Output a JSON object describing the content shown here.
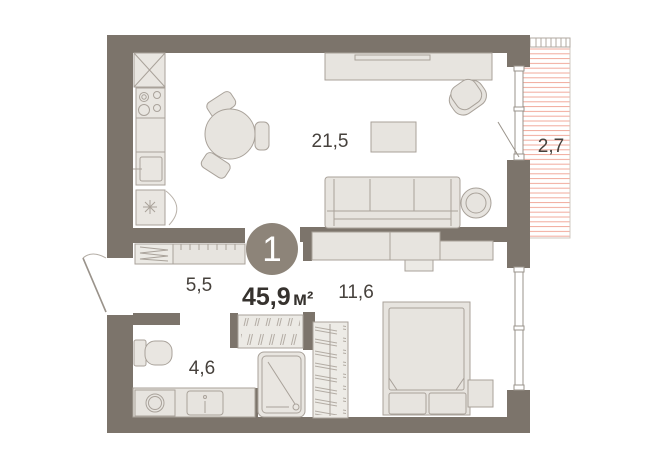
{
  "plan": {
    "unit_number": "1",
    "total_area_value": "45,9",
    "total_area_unit": "м²",
    "rooms": [
      {
        "id": "living-kitchen",
        "area_label": "21,5"
      },
      {
        "id": "balcony",
        "area_label": "2,7"
      },
      {
        "id": "hallway",
        "area_label": "5,5"
      },
      {
        "id": "bathroom",
        "area_label": "4,6"
      },
      {
        "id": "bedroom",
        "area_label": "11,6"
      }
    ],
    "colors": {
      "wall": "#7c746b",
      "furniture_fill": "#e7e4df",
      "furniture_stroke": "#a9a29a",
      "balcony_hatch": "#f1a99b",
      "badge": "#8d8479",
      "label_text": "#46413c"
    }
  }
}
